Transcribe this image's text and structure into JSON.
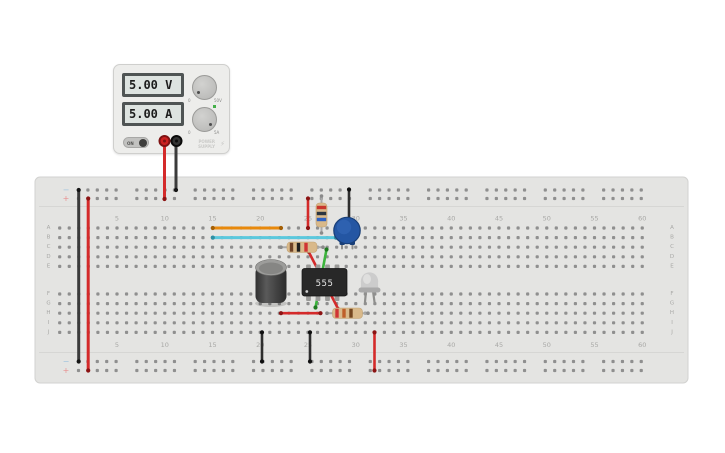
{
  "psu": {
    "voltage_display": "5.00 V",
    "current_display": "5.00 A",
    "on_label": "ON",
    "brand_line1": "POWER",
    "brand_line2": "SUPPLY",
    "bolt_icon": "⚡",
    "knob_top": {
      "min": "0",
      "max": "50V"
    },
    "knob_bottom": {
      "min": "0",
      "max": "5A"
    }
  },
  "scene": {
    "colors": {
      "board": "#e4e4e2",
      "board_border": "#d2d2d0",
      "divider": "#d6d6d4",
      "hole": "#8f8f8f",
      "label": "#a8a8a6",
      "minus": "#9fc3de",
      "plus": "#e89090",
      "lead": "#a9a9a9",
      "lead_cap": "#8a8a8a",
      "resistor_body": "#d9b98a",
      "resistor_edge": "#c2a374"
    },
    "board": {
      "x": 35,
      "y": 177,
      "w": 653,
      "h": 206,
      "dividers": [
        206.5,
        352.5
      ]
    },
    "rail_labels": {
      "minus": "−",
      "plus": "+"
    },
    "column_numbers": [
      "5",
      "10",
      "15",
      "20",
      "25",
      "30",
      "35",
      "40",
      "45",
      "50",
      "55",
      "60"
    ],
    "row_letters_top": [
      "A",
      "B",
      "C",
      "D",
      "E"
    ],
    "row_letters_bottom": [
      "F",
      "G",
      "H",
      "I",
      "J"
    ],
    "rails": {
      "rows": [
        190,
        198.5,
        361.5,
        370.5
      ],
      "group_start": 78.5,
      "group_pitch": 58.35,
      "hole_pitch": 9.4,
      "groups": 10,
      "holes_per_group": 5,
      "sign_x": 66
    },
    "grid": {
      "col_start": 59.7,
      "col_pitch": 9.55,
      "cols": 62,
      "rows_top": [
        228,
        237.6,
        247.2,
        256.8,
        266.4
      ],
      "rows_bottom": [
        294,
        303.6,
        313.2,
        322.8,
        332.4
      ],
      "label_anchor_value": 5,
      "label_anchor_x": 117,
      "label_rows_y": [
        218.5,
        345
      ],
      "letter_x": [
        48.5,
        672
      ]
    },
    "wires": [
      {
        "name": "psu-red-lead",
        "color": "#d42a2a",
        "cap": "#8c1313",
        "w": 3,
        "pts": [
          164.5,
          139,
          164.5,
          199
        ]
      },
      {
        "name": "psu-black-lead",
        "color": "#3b3b3b",
        "cap": "#151515",
        "w": 3,
        "pts": [
          176,
          139,
          176,
          190
        ]
      },
      {
        "name": "rail-jumper-black",
        "color": "#3b3b3b",
        "cap": "#151515",
        "w": 3,
        "pts": [
          78.7,
          190,
          78.7,
          361.5
        ]
      },
      {
        "name": "rail-jumper-red",
        "color": "#d42a2a",
        "cap": "#8c1313",
        "w": 3,
        "pts": [
          88.2,
          198.5,
          88.2,
          370.5
        ]
      },
      {
        "name": "orange-wire-rowA",
        "color": "#e8890c",
        "cap": "#a35f05",
        "w": 3,
        "pts": [
          212.8,
          228,
          281,
          228
        ]
      },
      {
        "name": "cyan-wire-rowB",
        "color": "#5bc8dd",
        "cap": "#2e8fa3",
        "w": 3,
        "pts": [
          212.8,
          237.6,
          336,
          237.6
        ]
      },
      {
        "name": "red-wire-plus-to-A25",
        "color": "#d42a2a",
        "cap": "#8c1313",
        "w": 2.6,
        "pts": [
          308,
          198.5,
          308,
          228
        ]
      },
      {
        "name": "black-wire-minus-to-cap",
        "color": "#2e2e2e",
        "cap": "#0f0f0f",
        "w": 2.6,
        "pts": [
          349,
          189.5,
          349,
          230
        ]
      },
      {
        "name": "green-wire-diagonal",
        "color": "#3cb43c",
        "cap": "#1f7a1f",
        "w": 2.6,
        "pts": [
          326.5,
          249.5,
          315.5,
          307.5
        ]
      },
      {
        "name": "red-wire-diagonal",
        "color": "#d42a2a",
        "cap": "#8c1313",
        "w": 2.6,
        "pts": [
          308.5,
          251.5,
          338.5,
          309.5
        ]
      },
      {
        "name": "red-wire-rowH",
        "color": "#d42a2a",
        "cap": "#8c1313",
        "w": 2.6,
        "pts": [
          281,
          313.2,
          320.5,
          313.2
        ]
      },
      {
        "name": "black-wire-J20-minus",
        "color": "#2e2e2e",
        "cap": "#0f0f0f",
        "w": 2.6,
        "pts": [
          262,
          332.4,
          262,
          361.5
        ]
      },
      {
        "name": "black-wire-J25-minus",
        "color": "#2e2e2e",
        "cap": "#0f0f0f",
        "w": 2.6,
        "pts": [
          310,
          332.4,
          310,
          361.5
        ]
      },
      {
        "name": "red-wire-J32-plus",
        "color": "#d42a2a",
        "cap": "#8c1313",
        "w": 2.6,
        "pts": [
          374.5,
          332.4,
          374.5,
          370.5
        ]
      }
    ],
    "resistors": [
      {
        "name": "resistor-vertical",
        "orient": "v",
        "lead": [
          321.5,
          196,
          321.5,
          233
        ],
        "body": [
          316,
          203,
          11,
          24
        ],
        "bands": [
          [
            207.5,
            "#c8372d"
          ],
          [
            213.5,
            "#2c3640"
          ],
          [
            219.5,
            "#2f62c4"
          ]
        ]
      },
      {
        "name": "resistor-rowC",
        "orient": "h",
        "lead": [
          281,
          247.2,
          323,
          247.2
        ],
        "body": [
          287,
          242,
          30,
          10.5
        ],
        "bands": [
          [
            291.5,
            "#6d4125"
          ],
          [
            298.5,
            "#1f1f1f"
          ],
          [
            306,
            "#d03434"
          ]
        ]
      },
      {
        "name": "resistor-rowH",
        "orient": "h",
        "lead": [
          327,
          313.2,
          368,
          313.2
        ],
        "body": [
          332.5,
          308,
          30,
          10.5
        ],
        "bands": [
          [
            337,
            "#d03434"
          ],
          [
            344,
            "#bf5f2a"
          ],
          [
            351,
            "#74461f"
          ]
        ]
      }
    ],
    "ic": {
      "label": "555",
      "body": [
        302,
        268.5,
        45,
        27.5
      ],
      "body_fill": "#282828",
      "pins_x": [
        308.5,
        318,
        327.5,
        337
      ],
      "pin_rows": [
        264.5,
        294.5
      ],
      "pin_fill": "#9a9a98",
      "text_color": "#e8e8e8",
      "dot": [
        306.8,
        291.5
      ]
    },
    "electrolytic": {
      "name": "electrolytic-capacitor",
      "cx": 271,
      "body": [
        255.5,
        266,
        31,
        37
      ],
      "top_ellipse": [
        271,
        267.5,
        15.5,
        8
      ],
      "top_fill": "#9d9d9b",
      "inner_fill": "#868684"
    },
    "disc_cap": {
      "name": "capacitor-blue",
      "cx": 347,
      "cy": 230.5,
      "r": 13.2,
      "fill": "#2456a3",
      "edge": "#193f78",
      "hi": "#3b6fc0",
      "legs": [
        [
          342,
          242,
          342,
          248.5
        ],
        [
          352.5,
          242,
          352.5,
          248.5
        ]
      ],
      "feet": [
        [
          339.5,
          240.5
        ],
        [
          349.5,
          240.5
        ]
      ]
    },
    "led": {
      "name": "led-white",
      "cx": 369.5,
      "dome_fill": "#cccccc",
      "flange_fill": "#a9a9a9",
      "legs": [
        [
          366,
          291,
          365,
          302
        ],
        [
          373,
          291,
          374.5,
          302
        ]
      ]
    },
    "terminals": [
      {
        "name": "psu-terminal-positive",
        "x": 164.5,
        "y": 141,
        "fill": "#cc2020",
        "ring": "#7e1212"
      },
      {
        "name": "psu-terminal-negative",
        "x": 176.5,
        "y": 141,
        "fill": "#333333",
        "ring": "#0a0a0a"
      }
    ]
  }
}
